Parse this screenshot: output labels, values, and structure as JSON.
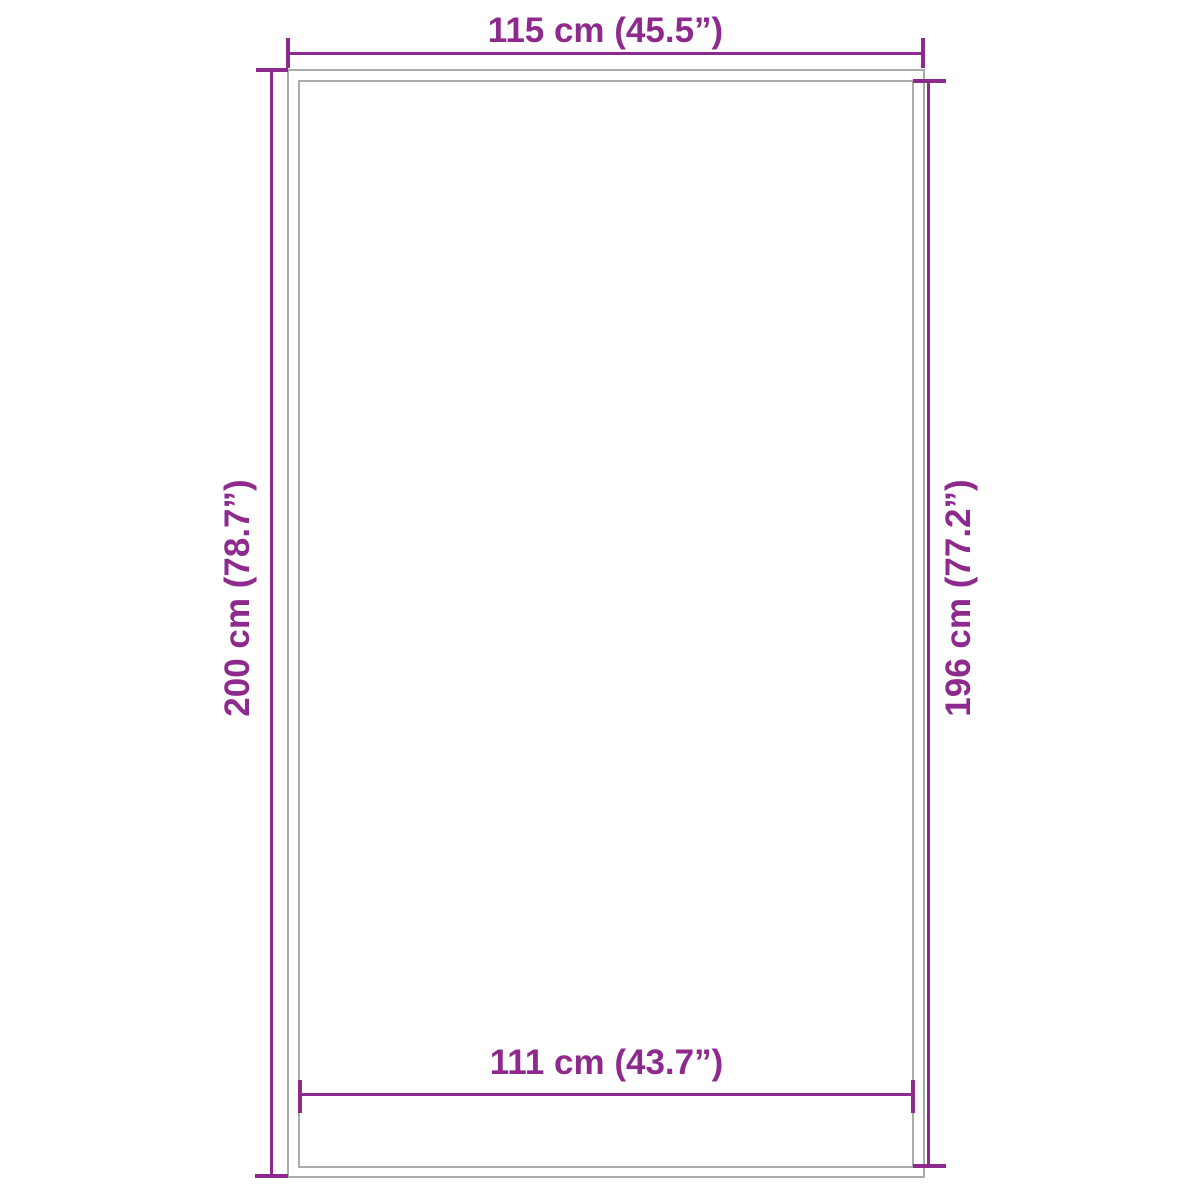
{
  "diagram": {
    "type": "product-dimension-diagram",
    "dimensions": {
      "top": {
        "label": "115 cm (45.5”)",
        "measures": "outer-width"
      },
      "left": {
        "label": "200 cm (78.7”)",
        "measures": "outer-height"
      },
      "right": {
        "label": "196 cm (77.2”)",
        "measures": "inner-height"
      },
      "bottom": {
        "label": "111 cm (43.7”)",
        "measures": "inner-width"
      }
    }
  },
  "colors": {
    "dimension": "#8e2a8d",
    "outline": "#ababab",
    "background": "#ffffff"
  }
}
